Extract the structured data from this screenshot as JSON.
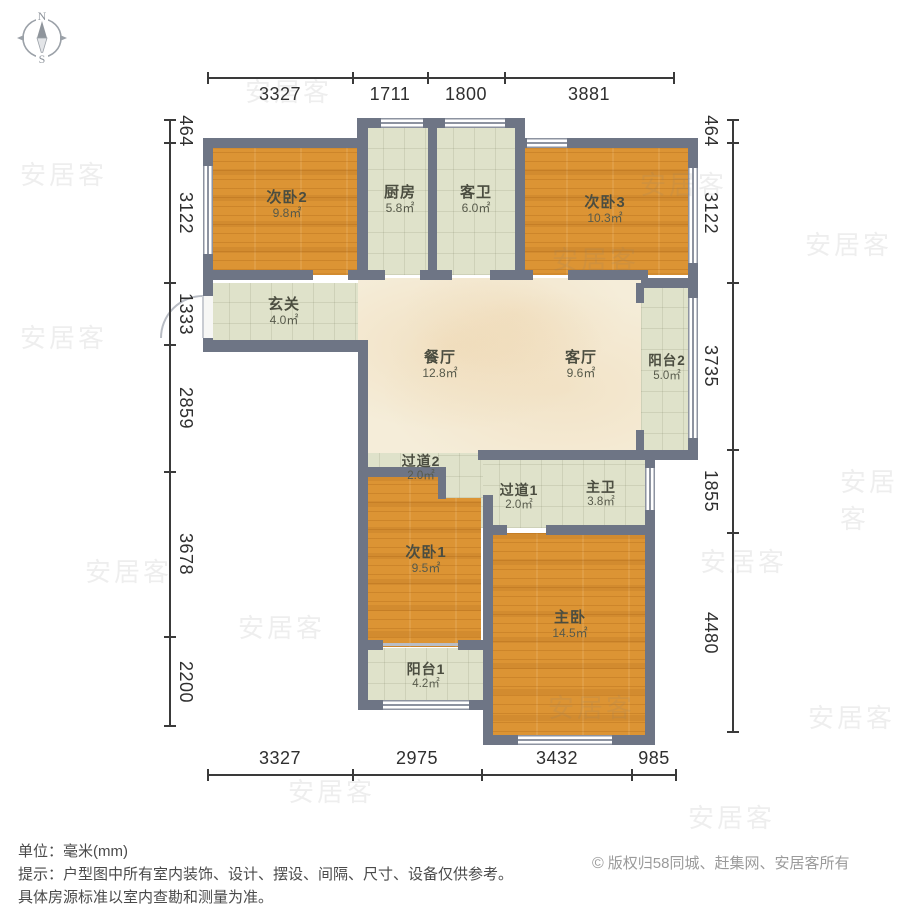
{
  "compass": {
    "north": "N",
    "south": "S"
  },
  "dimensions": {
    "top": [
      "3327",
      "1711",
      "1800",
      "3881"
    ],
    "bottom": [
      "3327",
      "2975",
      "3432",
      "985"
    ],
    "left": [
      "464",
      "3122",
      "1333",
      "2859",
      "3678",
      "2200"
    ],
    "right": [
      "464",
      "3122",
      "3735",
      "1855",
      "4480"
    ]
  },
  "rooms": [
    {
      "name": "次卧2",
      "area": "9.8㎡"
    },
    {
      "name": "厨房",
      "area": "5.8㎡"
    },
    {
      "name": "客卫",
      "area": "6.0㎡"
    },
    {
      "name": "次卧3",
      "area": "10.3㎡"
    },
    {
      "name": "玄关",
      "area": "4.0㎡"
    },
    {
      "name": "餐厅",
      "area": "12.8㎡"
    },
    {
      "name": "客厅",
      "area": "9.6㎡"
    },
    {
      "name": "阳台2",
      "area": "5.0㎡"
    },
    {
      "name": "过道2",
      "area": "2.0㎡"
    },
    {
      "name": "过道1",
      "area": "2.0㎡"
    },
    {
      "name": "主卫",
      "area": "3.8㎡"
    },
    {
      "name": "次卧1",
      "area": "9.5㎡"
    },
    {
      "name": "主卧",
      "area": "14.5㎡"
    },
    {
      "name": "阳台1",
      "area": "4.2㎡"
    }
  ],
  "footer": {
    "unit_line": "单位：毫米(mm)",
    "hint_line1": "提示：户型图中所有室内装饰、设计、摆设、间隔、尺寸、设备仅供参考。",
    "hint_line2": "具体房源标准以室内查勘和测量为准。",
    "copyright_symbol": "©",
    "copyright_text": "版权归58同城、赶集网、安居客所有"
  },
  "watermark": "安居客",
  "colors": {
    "wall": "#6e7585",
    "wood": "#dc9434",
    "tile": "#dfe2ca",
    "marble": "#f5edd9",
    "dimtext": "#2f2f2f",
    "hinttext": "#4a4a4a",
    "copytext": "#9b9b9b"
  }
}
